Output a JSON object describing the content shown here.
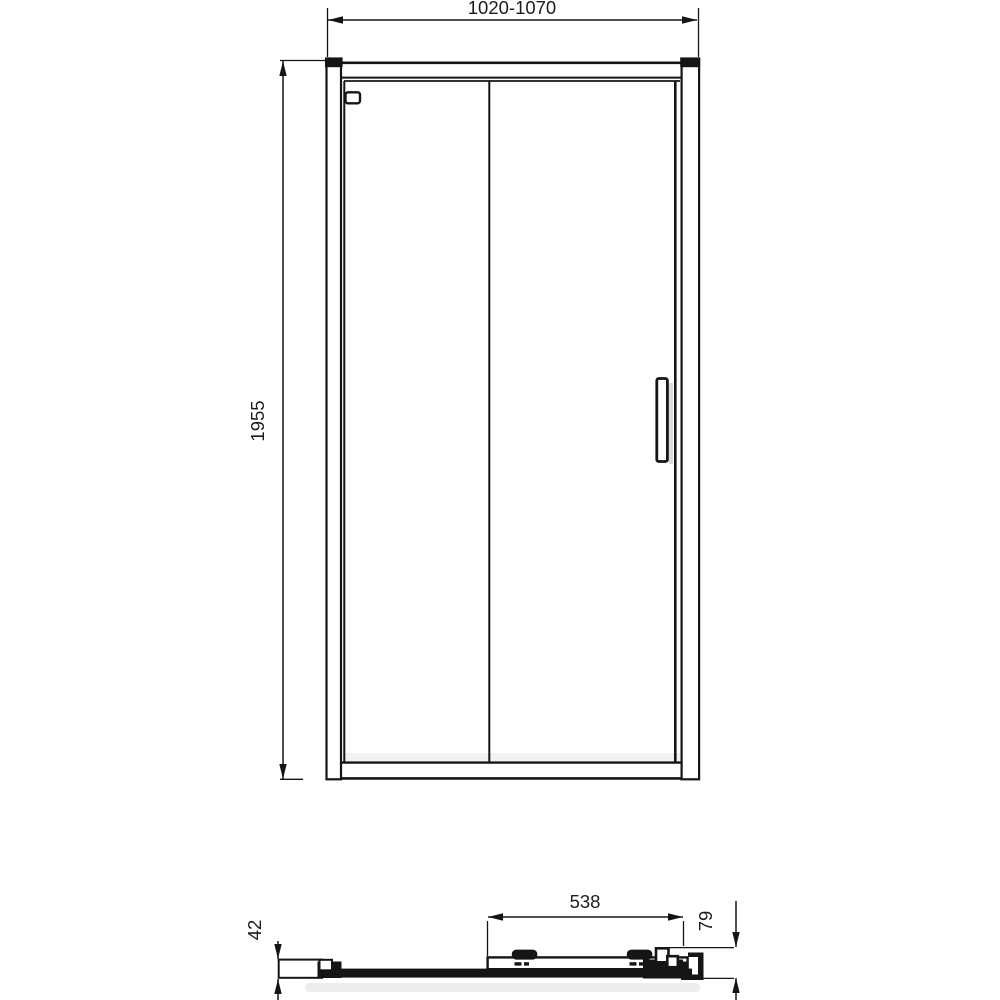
{
  "drawing": {
    "background_color": "#ffffff",
    "line_color": "#151515",
    "views": {
      "front_elevation": {
        "width_range_mm": "1020-1070",
        "height_mm": "1955"
      },
      "bottom_section": {
        "sliding_panel_width_mm": "538",
        "wall_profile_depth_mm": "42",
        "overall_depth_mm": "79"
      }
    }
  }
}
